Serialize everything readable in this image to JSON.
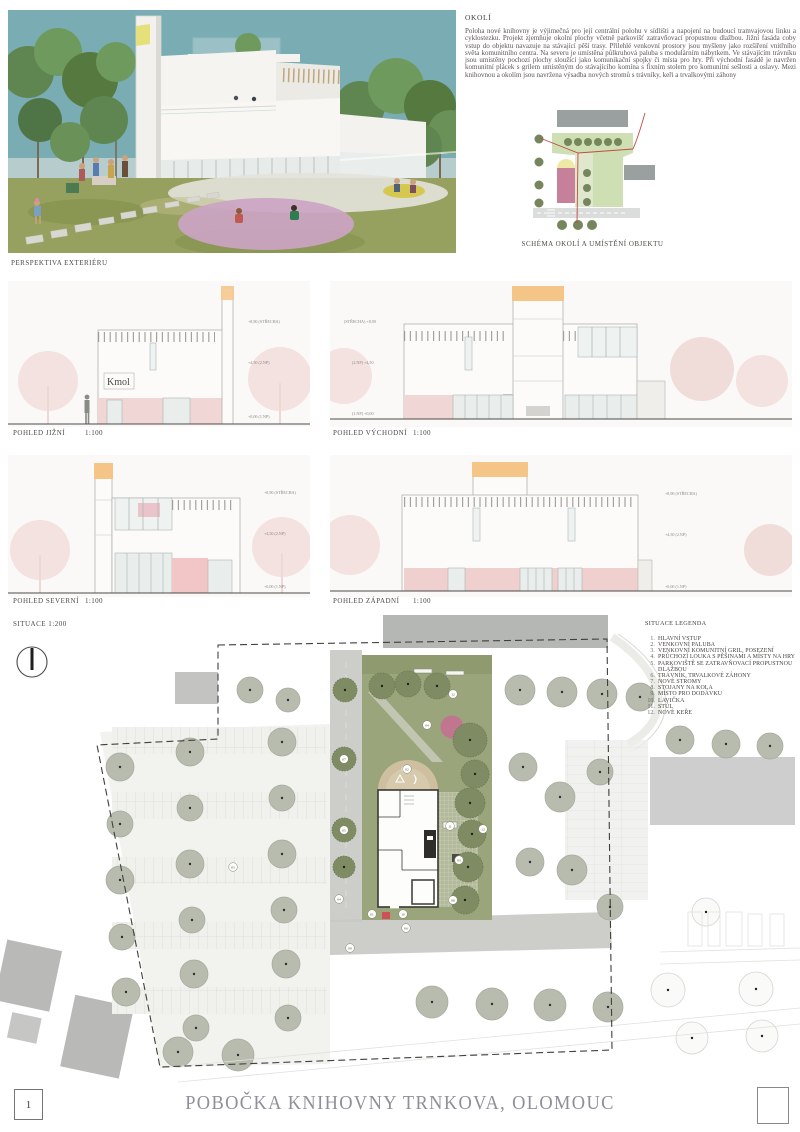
{
  "board": {
    "page_number": "1",
    "title": "POBOČKA KNIHOVNY TRNKOVA, OLOMOUC"
  },
  "perspective": {
    "caption": "PERSPEKTIVA EXTERIÉRU"
  },
  "okoli": {
    "heading": "OKOLÍ",
    "body": "Poloha nové knihovny je výjimečná pro její centrální polohu v sídlišti a napojení na budoucí tramvajovou linku a cyklostezku. Projekt zjemňuje okolní plochy včetně parkovišť zatravňovací propustnou dlažbou. Jižní fasáda coby vstup do objektu navazuje na stávající pěší trasy. Přilehlé venkovní prostory jsou myšleny jako rozšíření vnitřního světa komunitního centra. Na severu je umístěna půlkruhová paluba s modulárním nábytkem. Ve stávajícím trávníku jsou umístěny pochozí plochy sloužící jako komunikační spojky či místa pro hry. Při východní fasádě je navržen komunitní plácek s grilem umístěným do stávajícího komína s fixním stolem pro komunitní sešlosti a oslavy. Mezi knihovnou a okolím jsou navržena výsadba nových stromů s trávníky, keři a trvalkovými záhony"
  },
  "schema": {
    "caption": "SCHÉMA OKOLÍ A UMÍSTĚNÍ OBJEKTU"
  },
  "elevations": [
    {
      "label": "POHLED JIŽNÍ",
      "scale": "1:100",
      "signage": "Kmol",
      "marks": [
        "+8,90 (STŘECHA)",
        "+4,50 (2.NP)",
        "+0,00 (1.NP)"
      ]
    },
    {
      "label": "POHLED VÝCHODNÍ",
      "scale": "1:100",
      "marks": [
        "(STŘECHA) +8,90",
        "(2.NP) +4,50",
        "(1.NP) +0,00"
      ]
    },
    {
      "label": "POHLED SEVERNÍ",
      "scale": "1:100",
      "marks": [
        "+8,90 (STŘECHA)",
        "+4,50 (2.NP)",
        "+0,00 (1.NP)"
      ]
    },
    {
      "label": "POHLED ZÁPADNÍ",
      "scale": "1:100",
      "marks": [
        "+8,90 (STŘECHA)",
        "+4,50 (2.NP)",
        "+0,00 (1.NP)"
      ]
    }
  ],
  "situace": {
    "label": "SITUACE 1:200",
    "legend_heading": "SITUACE LEGENDA",
    "legend": [
      {
        "num": "1.",
        "text": "HLAVNÍ VSTUP"
      },
      {
        "num": "2.",
        "text": "VENKOVNÍ PALUBA"
      },
      {
        "num": "3.",
        "text": "VENKOVNÍ KOMUNITNÍ GRIL, POSEZENÍ"
      },
      {
        "num": "4.",
        "text": "PRŮCHOZÍ LOUKA S PĚŠINAMI A MÍSTY NA HRY"
      },
      {
        "num": "5.",
        "text": "PARKOVIŠTĚ SE ZATRAVŇOVACÍ PROPUSTNOU DLAŽBOU"
      },
      {
        "num": "6.",
        "text": "TRÁVNÍK, TRVALKOVÉ ZÁHONY"
      },
      {
        "num": "7.",
        "text": "NOVÉ STROMY"
      },
      {
        "num": "8.",
        "text": "STOJANY NA KOLA"
      },
      {
        "num": "9.",
        "text": "MÍSTO PRO DODÁVKU"
      },
      {
        "num": "10.",
        "text": "LAVIČKA"
      },
      {
        "num": "11.",
        "text": "STŮL"
      },
      {
        "num": "12.",
        "text": "NOVÉ KEŘE"
      }
    ],
    "markers": [
      "01",
      "02",
      "03",
      "04",
      "05",
      "06",
      "07",
      "08",
      "09",
      "10",
      "11",
      "12"
    ]
  },
  "colors": {
    "sky": "#79acb3",
    "accent_pink": "#c9a0c0",
    "accent_yellow": "#e6e07a",
    "accent_orange": "#f5c487",
    "plan_pink": "#c0768e",
    "title_gray": "#8f8f99"
  }
}
